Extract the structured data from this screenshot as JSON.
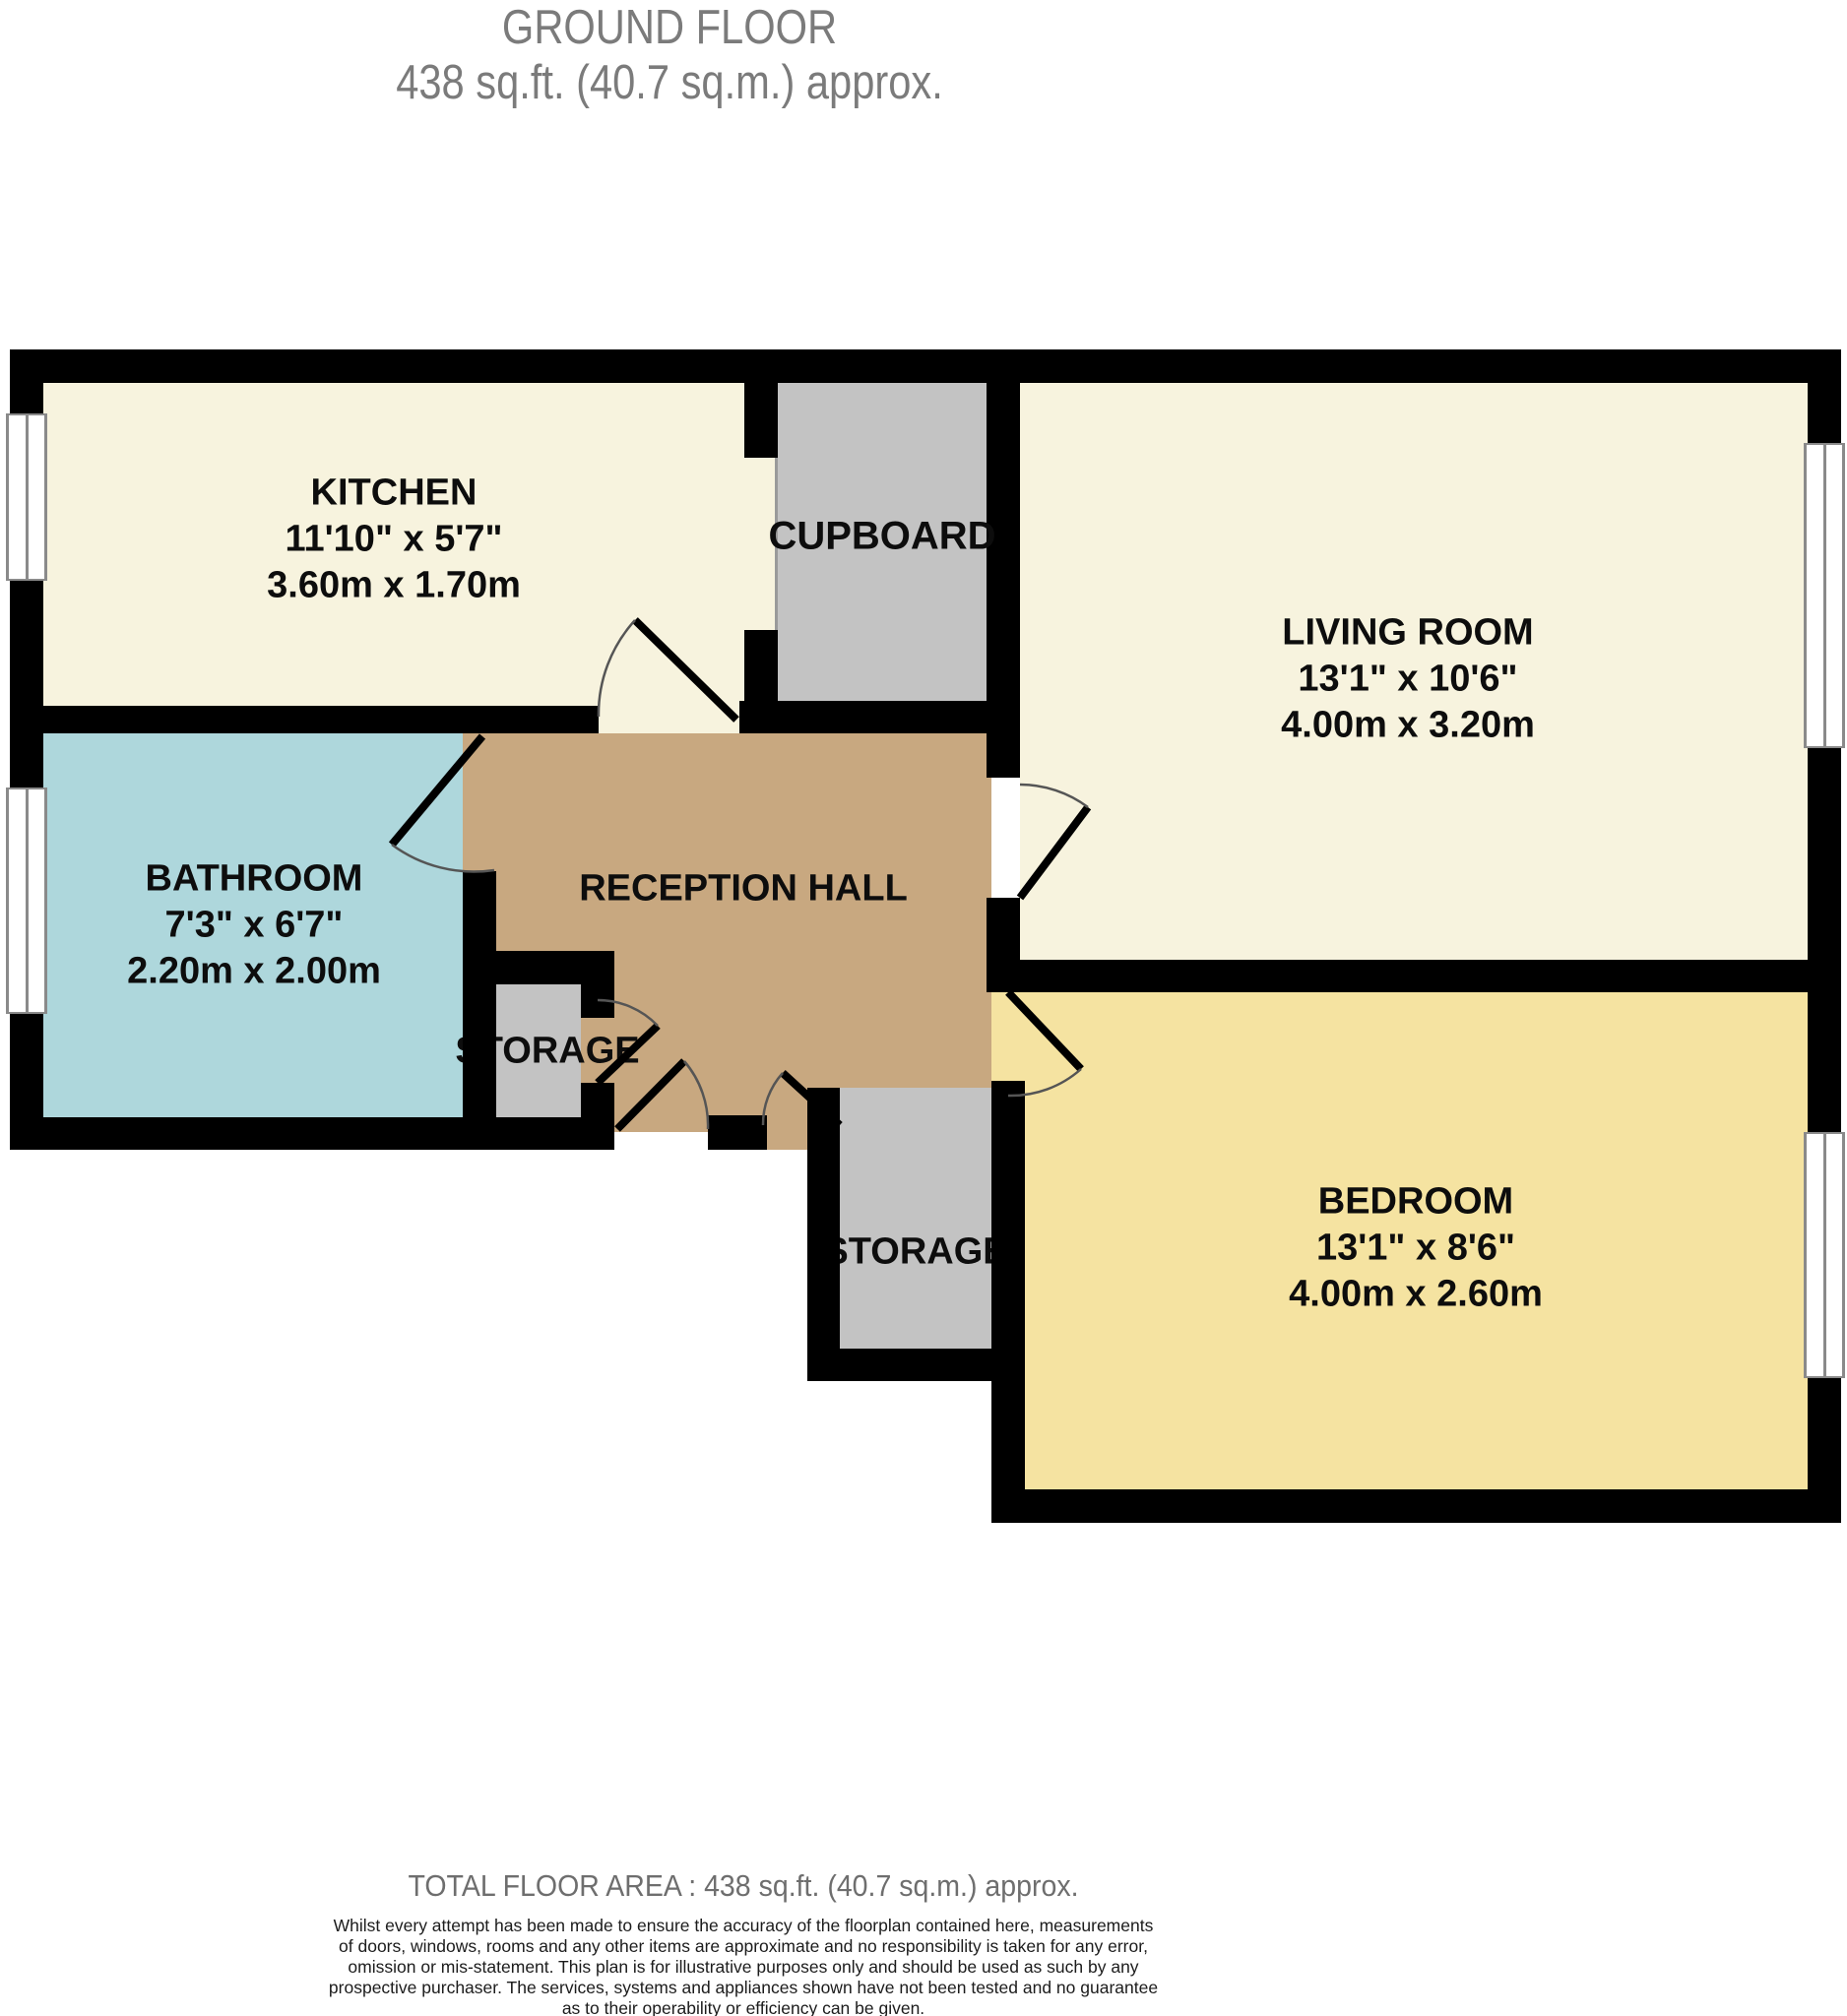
{
  "title": {
    "line1": "GROUND FLOOR",
    "line2": "438 sq.ft. (40.7 sq.m.) approx."
  },
  "rooms": {
    "kitchen": {
      "name": "KITCHEN",
      "imperial": "11'10\" x 5'7\"",
      "metric": "3.60m x 1.70m"
    },
    "cupboard": {
      "name": "CUPBOARD"
    },
    "living": {
      "name": "LIVING ROOM",
      "imperial": "13'1\" x 10'6\"",
      "metric": "4.00m x 3.20m"
    },
    "bathroom": {
      "name": "BATHROOM",
      "imperial": "7'3\" x 6'7\"",
      "metric": "2.20m x 2.00m"
    },
    "hall": {
      "name": "RECEPTION HALL"
    },
    "storage_small": {
      "name": "STORAGE"
    },
    "storage_bottom": {
      "name": "STORAGE"
    },
    "bedroom": {
      "name": "BEDROOM",
      "imperial": "13'1\" x 8'6\"",
      "metric": "4.00m x 2.60m"
    }
  },
  "footer": {
    "total_area": "TOTAL FLOOR AREA : 438 sq.ft. (40.7 sq.m.) approx.",
    "disclaimer_lines": [
      "Whilst every attempt has been made to ensure the accuracy of the floorplan contained here, measurements",
      "of doors, windows, rooms and any other items are approximate and no responsibility is taken for any error,",
      "omission or mis-statement. This plan is for illustrative purposes only and should be used as such by any",
      "prospective purchaser. The services, systems and appliances shown have not been tested and no guarantee",
      "as to their operability or efficiency can be given.",
      "Made with Metropix ©2024"
    ]
  },
  "colors": {
    "wall": "#000000",
    "kitchen_fill": "#F7F3DE",
    "living_fill": "#F7F3DE",
    "cupboard_fill": "#C3C3C3",
    "storage_fill": "#C3C3C3",
    "bathroom_fill": "#AED7DC",
    "hall_fill": "#C8A880",
    "bedroom_fill": "#F5E3A1",
    "title_text": "#7B7B7B",
    "window_line": "#8A8A8A"
  }
}
